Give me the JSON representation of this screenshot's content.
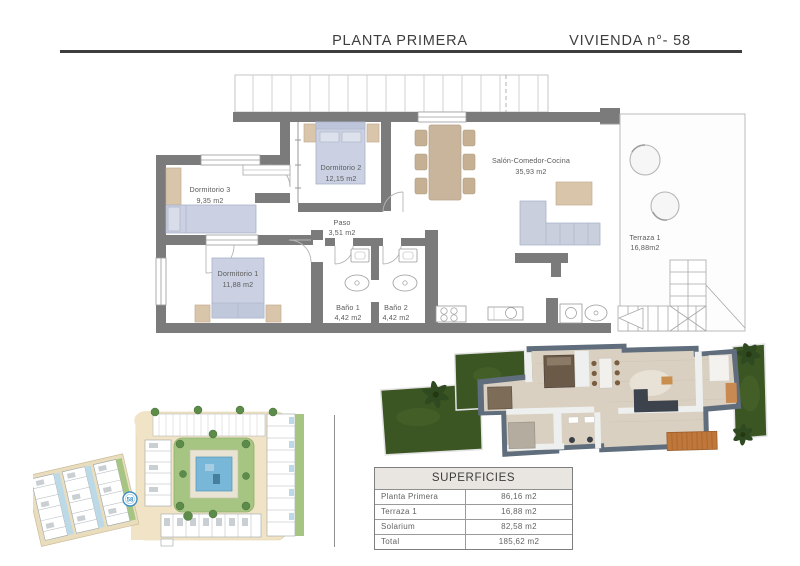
{
  "header": {
    "title": "PLANTA PRIMERA",
    "unit": "VIVIENDA n°- 58"
  },
  "floor_plan": {
    "rooms": [
      {
        "name": "Dormitorio 3",
        "area": "9,35 m2"
      },
      {
        "name": "Dormitorio 2",
        "area": "12,15 m2"
      },
      {
        "name": "Dormitorio 1",
        "area": "11,88 m2"
      },
      {
        "name": "Paso",
        "area": "3,51 m2"
      },
      {
        "name": "Baño 1",
        "area": "4,42 m2"
      },
      {
        "name": "Baño 2",
        "area": "4,42 m2"
      },
      {
        "name": "Salón-Comedor-Cocina",
        "area": "35,93 m2"
      },
      {
        "name": "Terraza 1",
        "area": "16,88m2"
      }
    ]
  },
  "site_plan": {
    "marker": "58"
  },
  "surfaces_table": {
    "title": "SUPERFICIES",
    "rows": [
      {
        "label": "Planta Primera",
        "value": "86,16 m2"
      },
      {
        "label": "Terraza 1",
        "value": "16,88 m2"
      },
      {
        "label": "Solarium",
        "value": "82,58 m2"
      },
      {
        "label": "Total",
        "value": "185,62 m2"
      }
    ]
  },
  "palette": {
    "wall_gray": "#7b7b7b",
    "furniture_blue": "#cbd1e2",
    "furniture_tan": "#d9c5aa",
    "site_green": "#a6c583",
    "site_road_cream": "#f1e4c6",
    "pool_blue": "#79b7d8",
    "render_wall_slate": "#5f6d7c",
    "render_floor_beige": "#d9d0c1",
    "render_grass": "#3c5623",
    "render_stairs_orange": "#c0773a",
    "marker_blue": "#3f8fc4",
    "table_header_bg": "#e9e6e2"
  }
}
